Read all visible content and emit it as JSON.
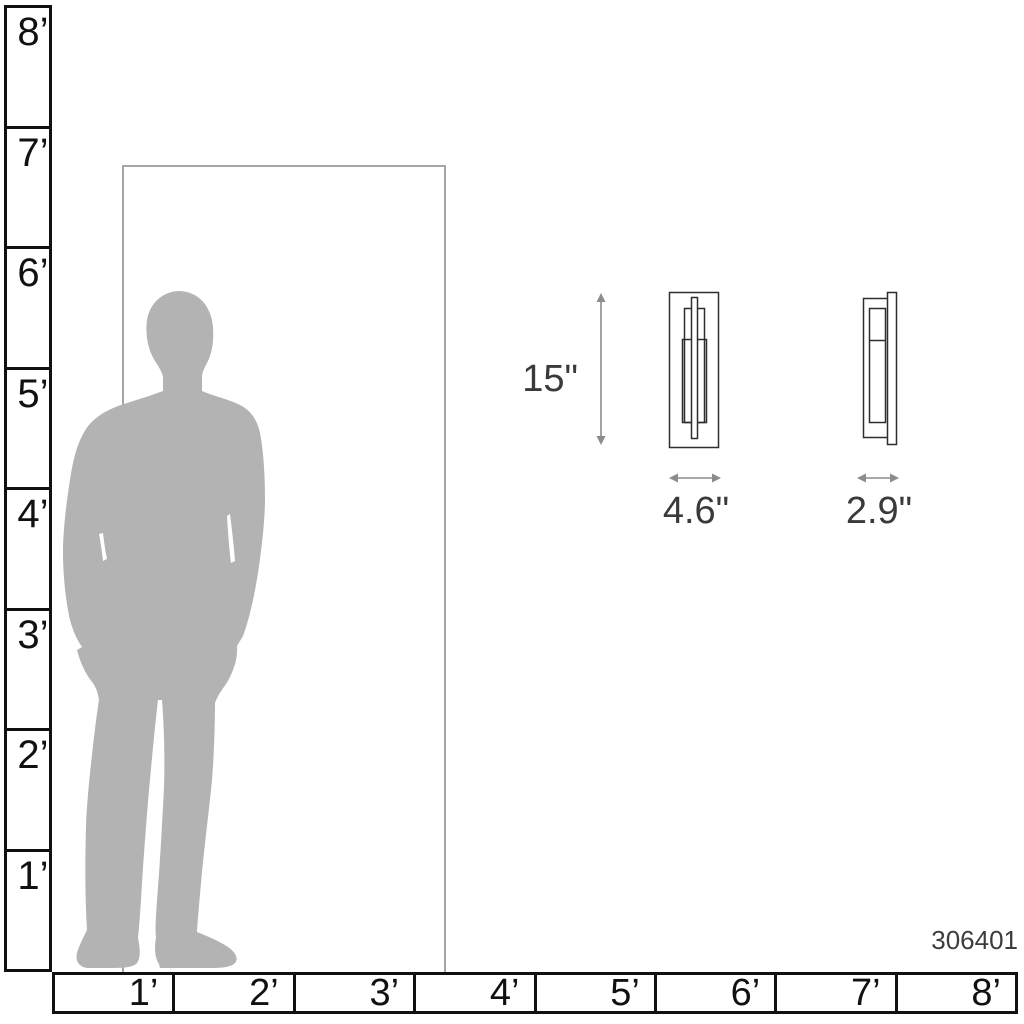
{
  "product_code": "306401",
  "dimensions": {
    "height": "15\"",
    "width": "4.6\"",
    "depth": "2.9\""
  },
  "vertical_ruler_labels": [
    "8’",
    "7’",
    "6’",
    "5’",
    "4’",
    "3’",
    "2’",
    "1’"
  ],
  "horizontal_ruler_labels": [
    "1’",
    "2’",
    "3’",
    "4’",
    "5’",
    "6’",
    "7’",
    "8’"
  ],
  "colors": {
    "silhouette": "#b3b3b3",
    "ruler_line": "#111111",
    "door_line": "#a6a6a6",
    "fixture_outline": "#2e2e2e",
    "arrow": "#8c8c8c",
    "label_text": "#3a3a3a"
  }
}
